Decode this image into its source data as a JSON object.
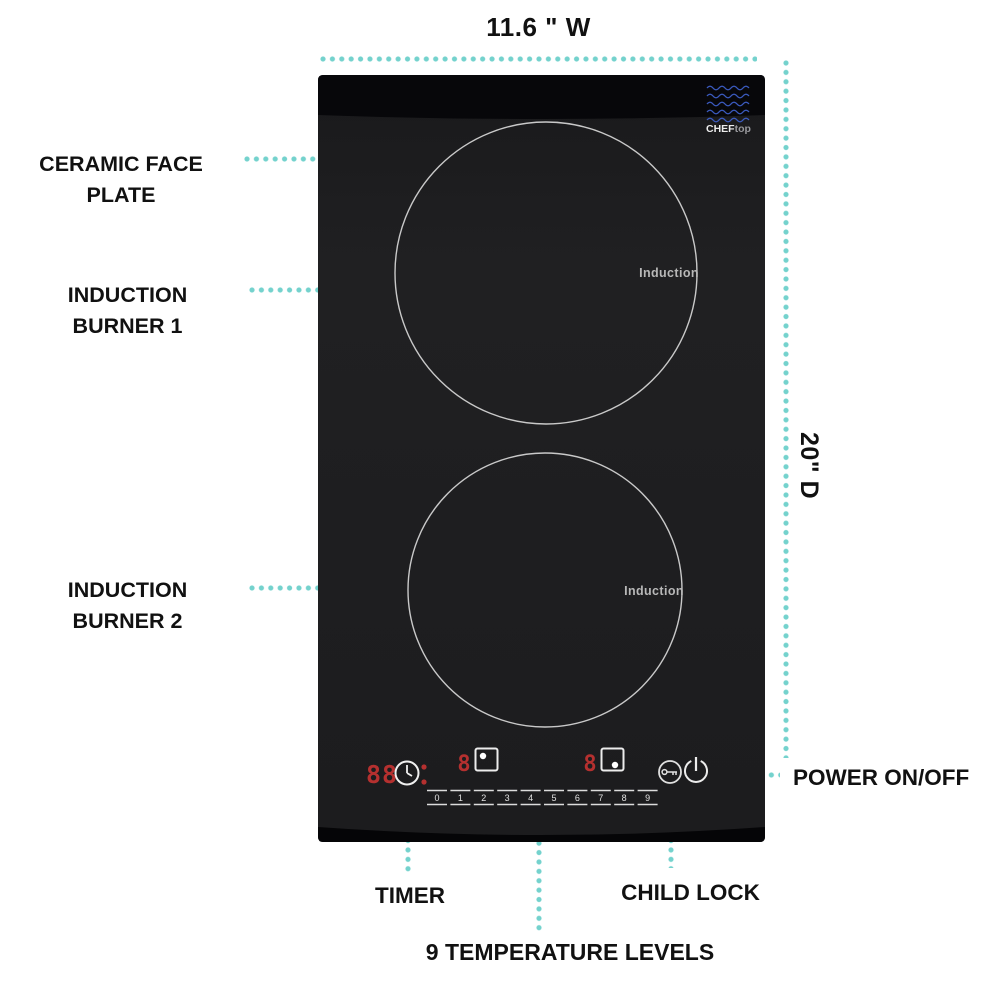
{
  "figure": {
    "width_dim_label": "11.6 \" W",
    "depth_dim_label": "20\" D"
  },
  "callouts": {
    "ceramic_face_plate": {
      "lines": [
        "CERAMIC FACE",
        "PLATE"
      ]
    },
    "induction_burner_1": {
      "lines": [
        "INDUCTION",
        "BURNER 1"
      ]
    },
    "induction_burner_2": {
      "lines": [
        "INDUCTION",
        "BURNER 2"
      ]
    },
    "power_on_off": "POWER ON/OFF",
    "timer": "TIMER",
    "child_lock": "CHILD LOCK",
    "temperature_levels": "9 TEMPERATURE LEVELS"
  },
  "cooktop": {
    "brand": {
      "bold": "CHEF",
      "light": "top"
    },
    "burner1_label": "Induction",
    "burner2_label": "Induction",
    "display": {
      "timer_digits": "88",
      "burner1_level": "8",
      "burner2_level": "8"
    },
    "temp_buttons": [
      "0",
      "1",
      "2",
      "3",
      "4",
      "5",
      "6",
      "7",
      "8",
      "9"
    ],
    "icons": {
      "clock": "clock-icon",
      "burner1_indicator": "square-dot-top-icon",
      "burner2_indicator": "square-dot-bottom-icon",
      "child_lock": "key-icon",
      "power": "power-icon",
      "logo_waves": "wave-lines-icon"
    }
  },
  "colors": {
    "leader_teal": "#74d2cd",
    "led_red": "#b5302f",
    "logo_blue": "#3d5ec7",
    "surface_black": "#1d1d1f",
    "band_black": "#07070a",
    "circle_stroke": "#c9c9c9",
    "label_text": "#111111",
    "background": "#ffffff"
  }
}
